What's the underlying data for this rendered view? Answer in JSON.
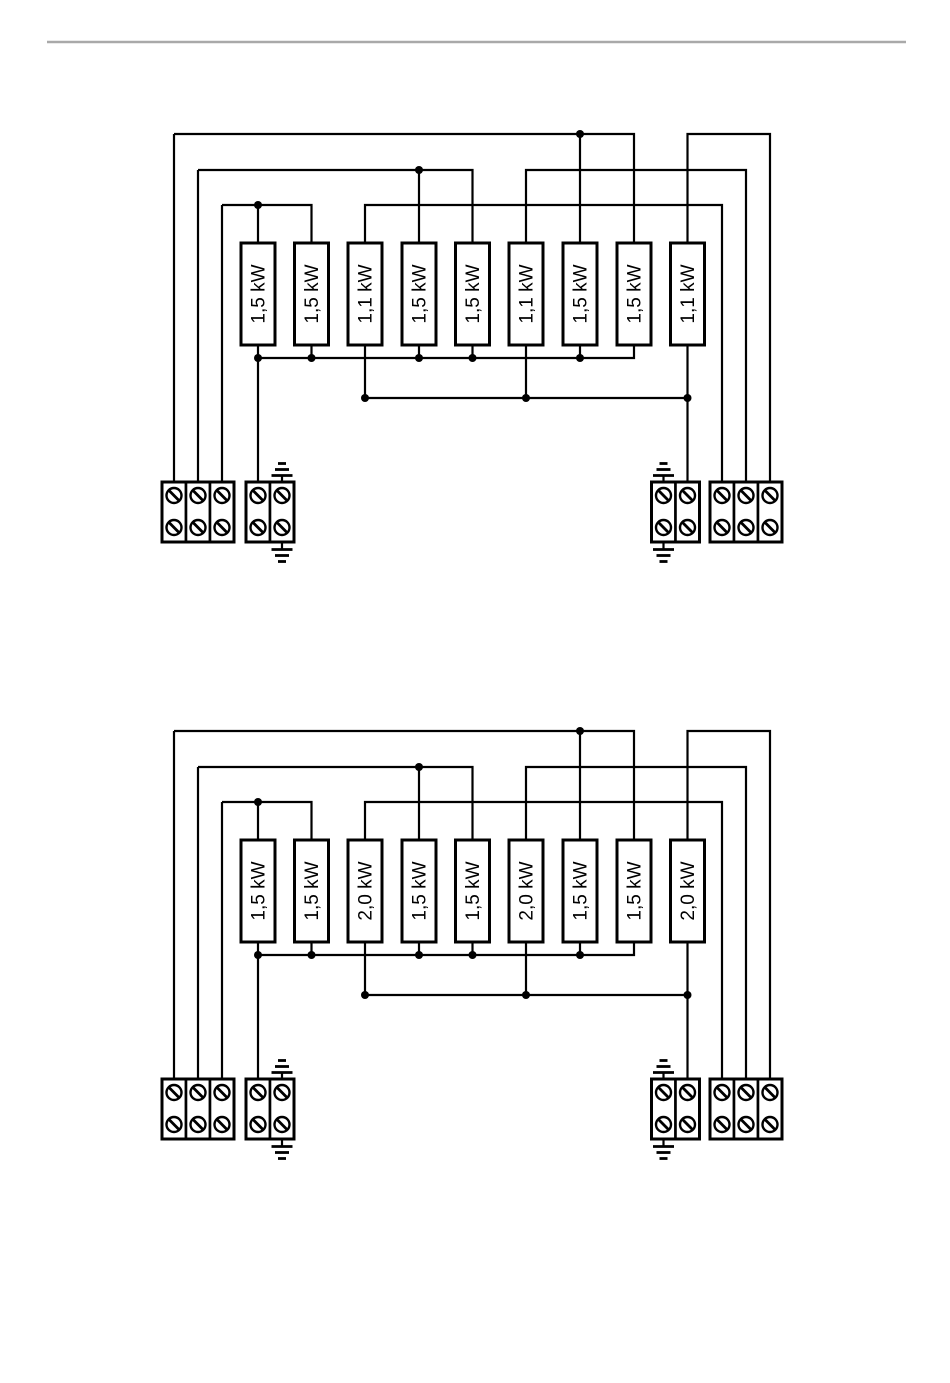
{
  "page": {
    "divider_color": "#a9a9a9"
  },
  "diagrams": [
    {
      "elements": [
        "1,5 kW",
        "1,5 kW",
        "1,1 kW",
        "1,5 kW",
        "1,5 kW",
        "1,1 kW",
        "1,5 kW",
        "1,5 kW",
        "1,1 kW"
      ]
    },
    {
      "elements": [
        "1,5 kW",
        "1,5 kW",
        "2,0 kW",
        "1,5 kW",
        "1,5 kW",
        "2,0 kW",
        "1,5 kW",
        "1,5 kW",
        "2,0 kW"
      ]
    }
  ]
}
